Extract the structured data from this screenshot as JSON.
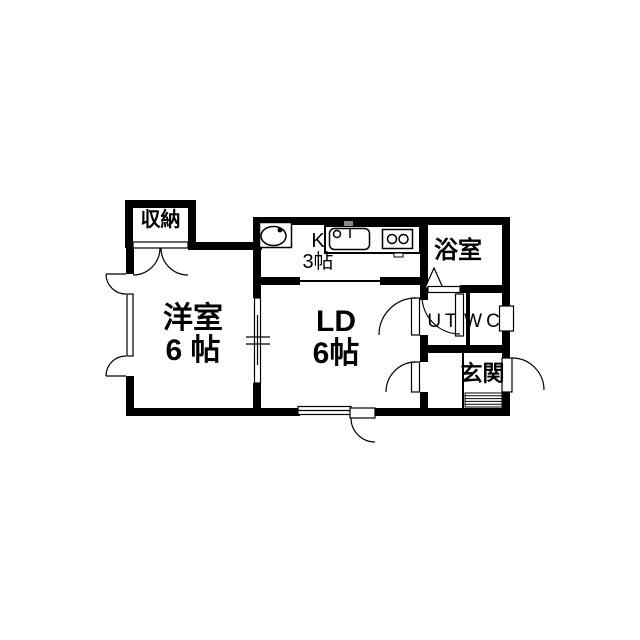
{
  "rooms": {
    "storage": {
      "label": "収納"
    },
    "western_room": {
      "label": "洋室",
      "size": "6 帖"
    },
    "kitchen": {
      "label": "K",
      "size": "3帖"
    },
    "living_dining": {
      "label": "LD",
      "size": "6帖"
    },
    "bathroom": {
      "label": "浴室"
    },
    "utility": {
      "label": "UT"
    },
    "toilet": {
      "label": "WC"
    },
    "entrance": {
      "label": "玄関"
    }
  },
  "fixtures": {
    "washbasin": "washbasin-icon",
    "kitchen_sink": "kitchen-sink-icon",
    "stove": "two-burner-stove-icon",
    "bath_door": "folding-door-icon",
    "doormat": "entrance-doormat"
  },
  "colors": {
    "wall": "#000000",
    "background": "#ffffff",
    "text": "#000000"
  }
}
